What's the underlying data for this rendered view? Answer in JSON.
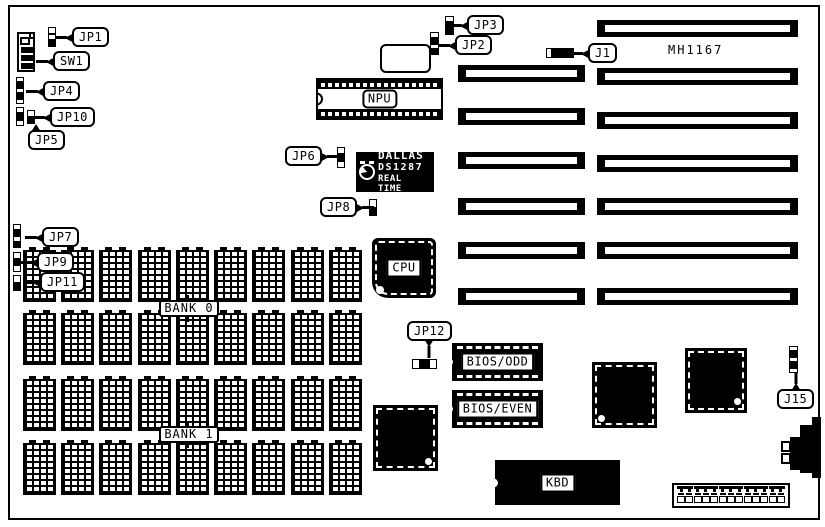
{
  "diagram": {
    "type": "motherboard-jumper-diagram",
    "board_model": "MH1167",
    "colors": {
      "ink": "#000000",
      "paper": "#ffffff"
    },
    "callouts": {
      "jp1": "JP1",
      "sw1": "SW1",
      "jp4": "JP4",
      "jp10": "JP10",
      "jp5": "JP5",
      "jp7": "JP7",
      "jp9": "JP9",
      "jp11": "JP11",
      "jp6": "JP6",
      "jp8": "JP8",
      "jp3": "JP3",
      "jp2": "JP2",
      "j1": "J1",
      "jp12": "JP12",
      "j15": "J15"
    },
    "chips": {
      "npu": "NPU",
      "cpu": "CPU",
      "kbd": "KBD",
      "bios_odd": "BIOS/ODD",
      "bios_even": "BIOS/EVEN",
      "rtc": {
        "line1": "DALLAS",
        "line2": "DS1287",
        "line3": "REAL TIME"
      }
    },
    "memory": {
      "bank0": "BANK 0",
      "bank1": "BANK 1",
      "rows": 4,
      "chips_per_row": 9
    },
    "slots": {
      "left_count": 6,
      "right_count": 7
    },
    "pin_header_pins": 13
  }
}
